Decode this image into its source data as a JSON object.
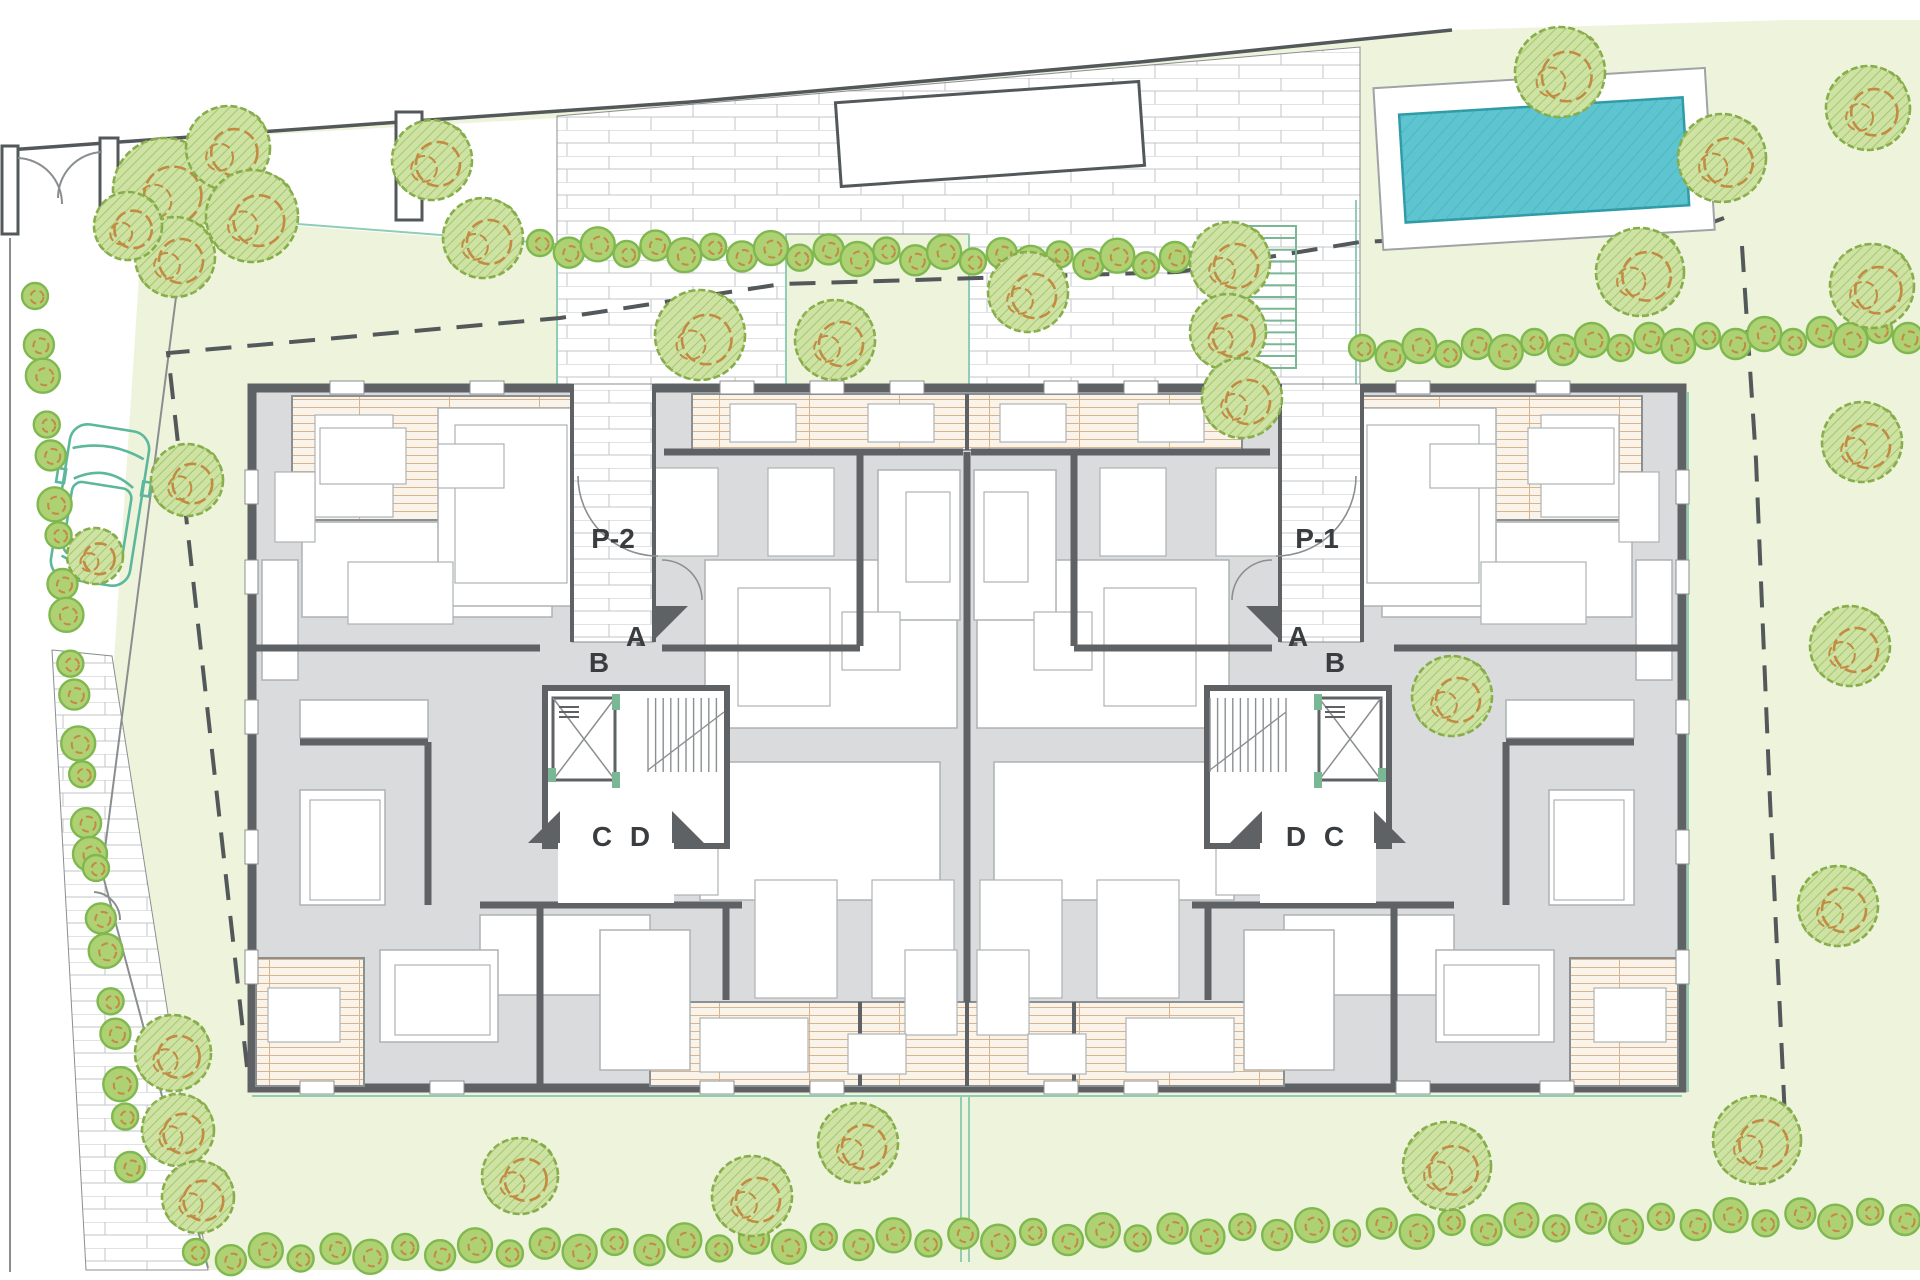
{
  "labels": {
    "entry_left": "P-2",
    "entry_right": "P-1",
    "door_a": "A",
    "door_b": "B",
    "door_c": "C",
    "door_d": "D"
  },
  "icons": {
    "tree": "hatched-canopy-circle",
    "hedge-bush": "scalloped-bush-circle",
    "car": "car-top-view-outline",
    "elevator": "box-with-x-cross",
    "stairs": "tread-lines",
    "pool": "hatched-water-rectangle",
    "gate": "door-swing-arc"
  },
  "colors": {
    "lawn": "#eef3dc",
    "brickLine": "#c2c6c8",
    "wall": "#5e6264",
    "wallLight": "#8b8f91",
    "roomFill": "#dadbdc",
    "furnLine": "#aeb2b4",
    "terraceBg": "#faf3ea",
    "terraceLine": "#d9b48c",
    "pool": "#5ec4cf",
    "poolEdge": "#2f9ba7",
    "poolHatch": "#3fb0bc",
    "deckLine": "#9fa3a5",
    "treeLight": "#cde2a3",
    "treeDark": "#9cc162",
    "treeStroke": "#86ad49",
    "treeOrange": "#c28a42",
    "hedgeFill": "#aed174",
    "hedgeStroke": "#7fb84e",
    "teal": "#8fcdb4",
    "car": "#5cb79c",
    "stairGreen": "#79b795",
    "label": "#3a3d3f",
    "dash": "#53585a",
    "siteLine": "#8a8e90"
  }
}
